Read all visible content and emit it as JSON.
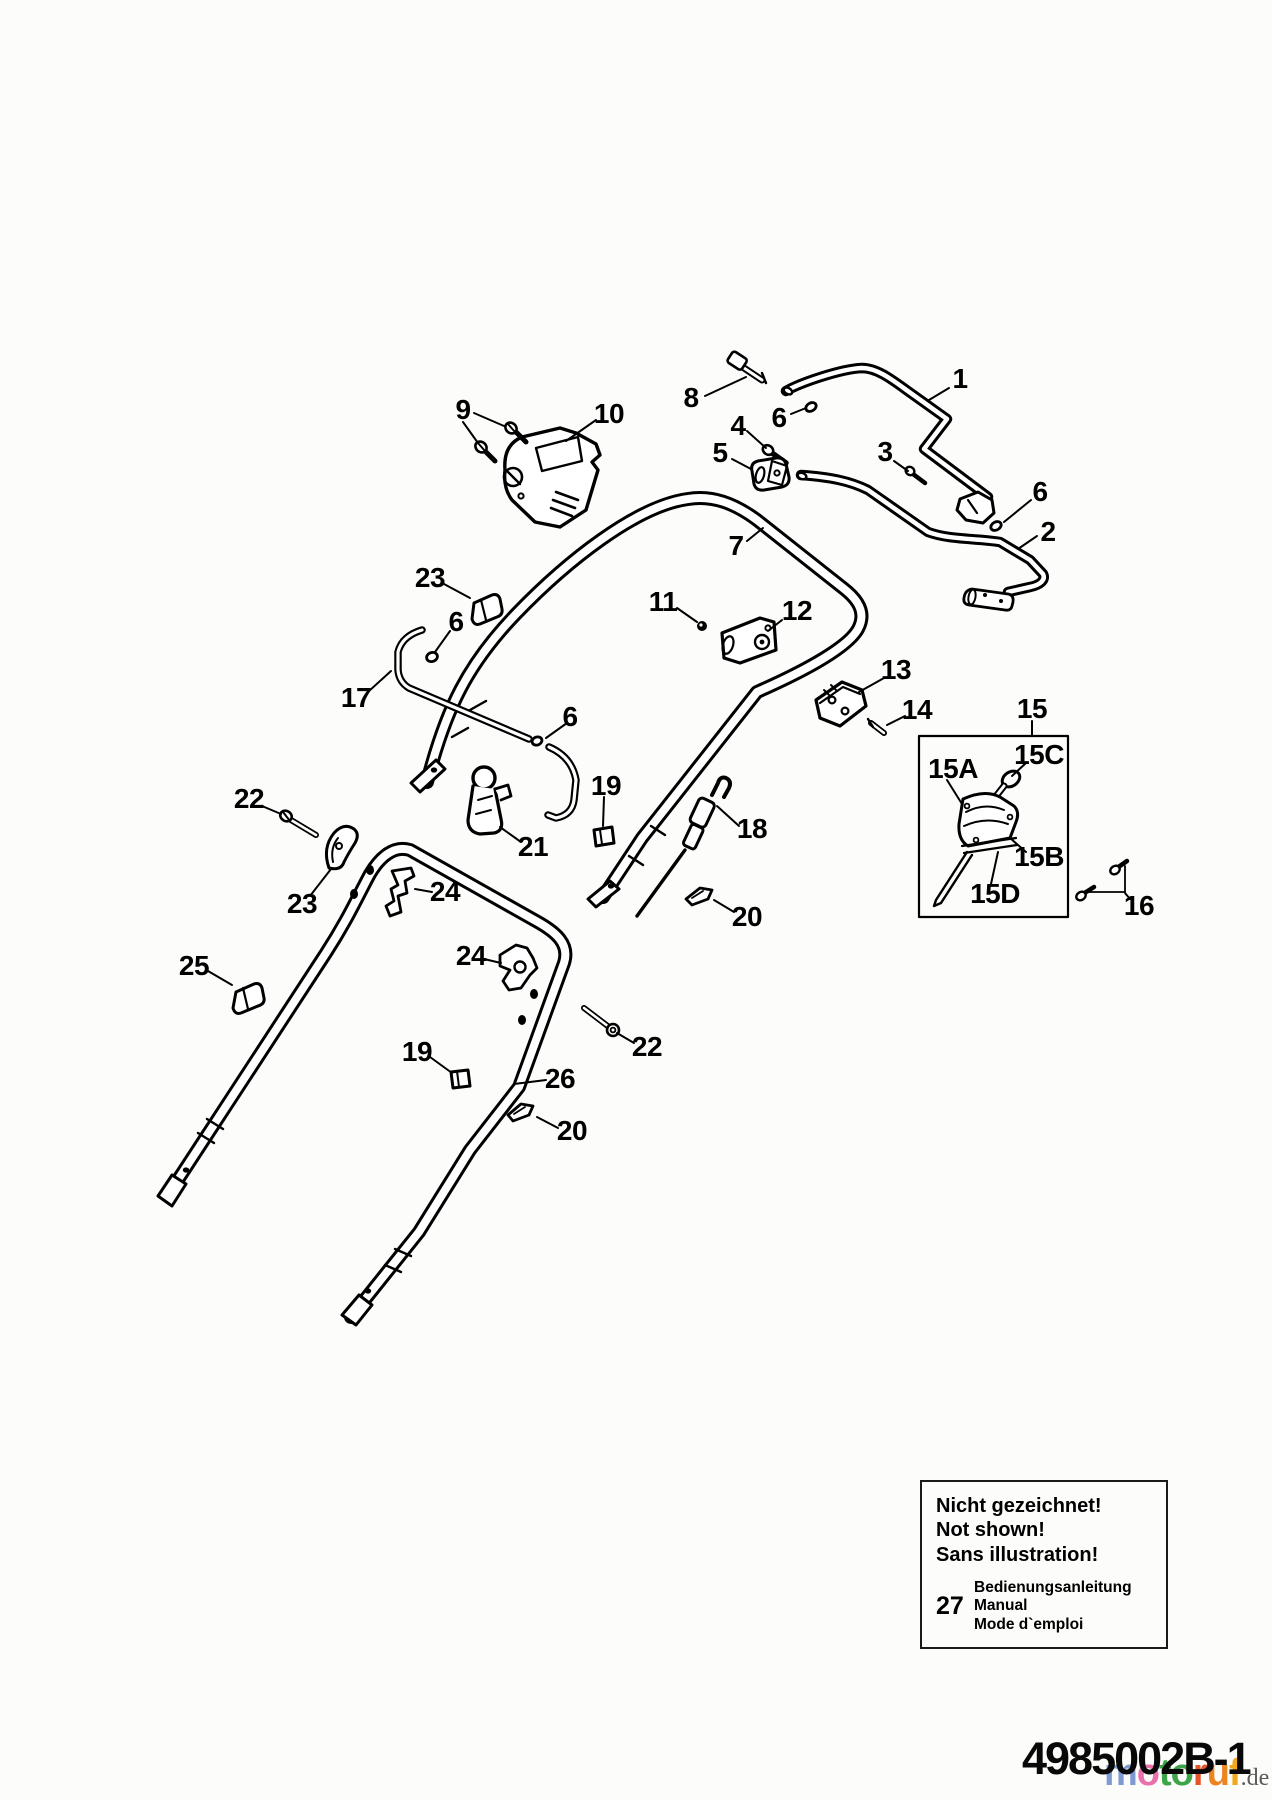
{
  "page": {
    "background": "#fcfcfa",
    "ink_color": "#000000",
    "diagram_subject": "handlebar exploded parts diagram"
  },
  "callouts": [
    {
      "key": "1",
      "label": "1",
      "x": 960,
      "y": 379
    },
    {
      "key": "2",
      "label": "2",
      "x": 1048,
      "y": 532
    },
    {
      "key": "3",
      "label": "3",
      "x": 885,
      "y": 452
    },
    {
      "key": "4",
      "label": "4",
      "x": 738,
      "y": 426
    },
    {
      "key": "5",
      "label": "5",
      "x": 720,
      "y": 453
    },
    {
      "key": "6a",
      "label": "6",
      "x": 779,
      "y": 418
    },
    {
      "key": "6b",
      "label": "6",
      "x": 456,
      "y": 622
    },
    {
      "key": "6c",
      "label": "6",
      "x": 1040,
      "y": 492
    },
    {
      "key": "6d",
      "label": "6",
      "x": 570,
      "y": 717
    },
    {
      "key": "7",
      "label": "7",
      "x": 736,
      "y": 546
    },
    {
      "key": "8",
      "label": "8",
      "x": 691,
      "y": 398
    },
    {
      "key": "9",
      "label": "9",
      "x": 463,
      "y": 410
    },
    {
      "key": "10",
      "label": "10",
      "x": 609,
      "y": 414
    },
    {
      "key": "11",
      "label": "11",
      "x": 663,
      "y": 602
    },
    {
      "key": "12",
      "label": "12",
      "x": 797,
      "y": 611
    },
    {
      "key": "13",
      "label": "13",
      "x": 896,
      "y": 670
    },
    {
      "key": "14",
      "label": "14",
      "x": 917,
      "y": 710
    },
    {
      "key": "15",
      "label": "15",
      "x": 1032,
      "y": 709
    },
    {
      "key": "15A",
      "label": "15A",
      "x": 953,
      "y": 769
    },
    {
      "key": "15B",
      "label": "15B",
      "x": 1039,
      "y": 857
    },
    {
      "key": "15C",
      "label": "15C",
      "x": 1039,
      "y": 755
    },
    {
      "key": "15D",
      "label": "15D",
      "x": 995,
      "y": 894
    },
    {
      "key": "16",
      "label": "16",
      "x": 1139,
      "y": 906
    },
    {
      "key": "17",
      "label": "17",
      "x": 356,
      "y": 698
    },
    {
      "key": "18",
      "label": "18",
      "x": 752,
      "y": 829
    },
    {
      "key": "19a",
      "label": "19",
      "x": 606,
      "y": 786
    },
    {
      "key": "19b",
      "label": "19",
      "x": 417,
      "y": 1052
    },
    {
      "key": "20a",
      "label": "20",
      "x": 747,
      "y": 917
    },
    {
      "key": "20b",
      "label": "20",
      "x": 572,
      "y": 1131
    },
    {
      "key": "21",
      "label": "21",
      "x": 533,
      "y": 847
    },
    {
      "key": "22a",
      "label": "22",
      "x": 249,
      "y": 799
    },
    {
      "key": "22b",
      "label": "22",
      "x": 647,
      "y": 1047
    },
    {
      "key": "23a",
      "label": "23",
      "x": 430,
      "y": 578
    },
    {
      "key": "23b",
      "label": "23",
      "x": 302,
      "y": 904
    },
    {
      "key": "24a",
      "label": "24",
      "x": 445,
      "y": 892
    },
    {
      "key": "24b",
      "label": "24",
      "x": 471,
      "y": 956
    },
    {
      "key": "25",
      "label": "25",
      "x": 194,
      "y": 966
    },
    {
      "key": "26",
      "label": "26",
      "x": 560,
      "y": 1079
    }
  ],
  "note_box": {
    "lines": [
      "Nicht gezeichnet!",
      "Not shown!",
      "Sans illustration!"
    ],
    "item_number": "27",
    "item_lines": [
      "Bedienungsanleitung",
      "Manual",
      "Mode d`emploi"
    ]
  },
  "footer": {
    "document_code": "4985002B-1"
  },
  "watermark": {
    "letters": [
      {
        "ch": "m",
        "color": "#7d9bd2"
      },
      {
        "ch": "o",
        "color": "#e970ab"
      },
      {
        "ch": "t",
        "color": "#3da44a"
      },
      {
        "ch": "o",
        "color": "#3da44a"
      },
      {
        "ch": "r",
        "color": "#e4552a"
      },
      {
        "ch": "u",
        "color": "#ec8420"
      },
      {
        "ch": "f",
        "color": "#f2a81c"
      }
    ],
    "suffix": ".de",
    "suffix_color": "#5a5a5a"
  }
}
